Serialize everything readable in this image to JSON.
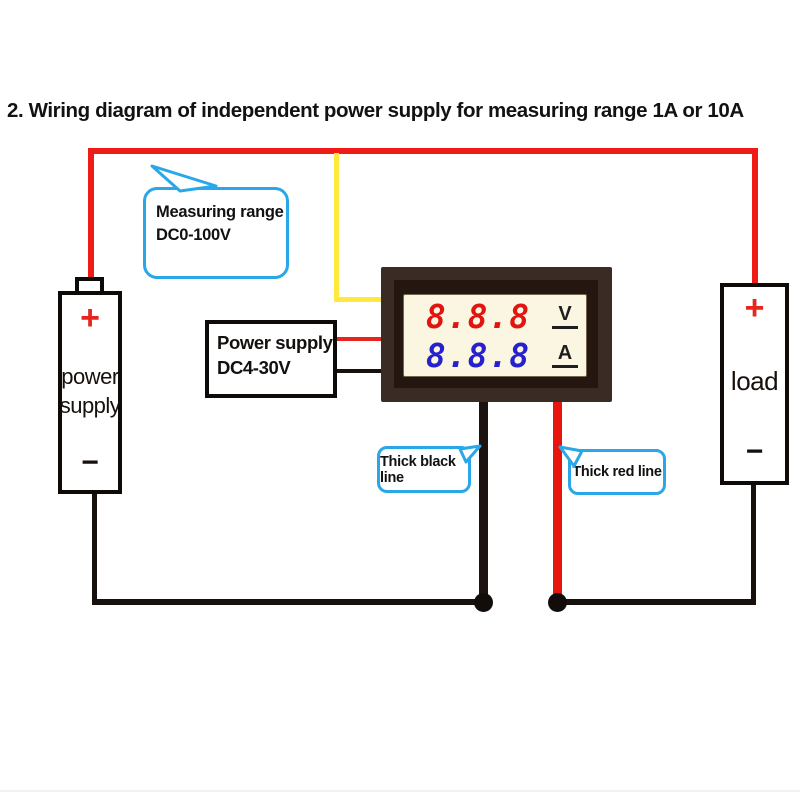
{
  "title": "2. Wiring diagram of independent power supply for measuring range 1A or 10A",
  "meter": {
    "volt_reading": "8.8.8",
    "volt_unit": "V",
    "amp_reading": "8.8.8",
    "amp_unit": "A"
  },
  "power_supply_unit": {
    "plus": "+",
    "label_line1": "power",
    "label_line2": "supply",
    "minus": "−"
  },
  "load_unit": {
    "plus": "+",
    "label": "load",
    "minus": "−"
  },
  "labels": {
    "measuring_range": {
      "line1": "Measuring range",
      "line2": "DC0-100V"
    },
    "power_supply_box": {
      "line1": "Power supply",
      "line2": "DC4-30V"
    },
    "thick_black_line": "Thick black line",
    "thick_red_line": "Thick red line"
  },
  "colors": {
    "wire_red": "#ee1b16",
    "wire_yellow": "#ffe93f",
    "wire_black": "#17100c",
    "thick_black_line": "#1c1210",
    "thick_red_line": "#e8150e",
    "bubble_border": "#2aa7e8",
    "meter_frame_outer": "#3a2c25",
    "meter_frame_inner": "#241710",
    "meter_display_bg": "#fbf6e2",
    "digit_red": "#e21410",
    "digit_blue": "#2621cd",
    "plus_red": "#e8251c"
  }
}
